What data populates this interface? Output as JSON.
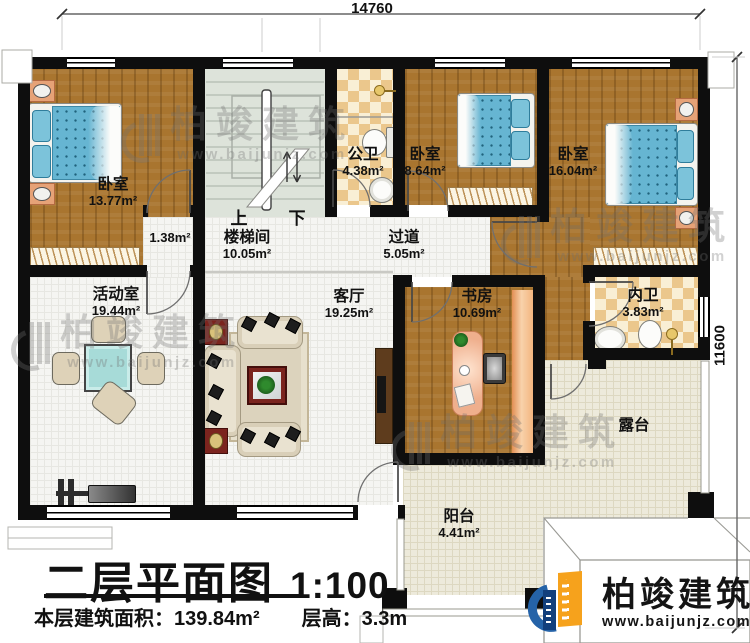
{
  "dimensions": {
    "top": "14760",
    "right": "11600"
  },
  "rooms": {
    "bedroom_left": {
      "name": "卧室",
      "area": "13.77m²"
    },
    "small_hall": {
      "area": "1.38m²"
    },
    "stairwell": {
      "name": "楼梯间",
      "area": "10.05m²",
      "up": "上",
      "down": "下"
    },
    "public_bath": {
      "name": "公卫",
      "area": "4.38m²"
    },
    "bedroom_mid": {
      "name": "卧室",
      "area": "8.64m²"
    },
    "bedroom_right": {
      "name": "卧室",
      "area": "16.04m²"
    },
    "hallway": {
      "name": "过道",
      "area": "5.05m²"
    },
    "activity": {
      "name": "活动室",
      "area": "19.44m²"
    },
    "living": {
      "name": "客厅",
      "area": "19.25m²"
    },
    "study": {
      "name": "书房",
      "area": "10.69m²"
    },
    "ensuite_bath": {
      "name": "内卫",
      "area": "3.83m²"
    },
    "terrace": {
      "name": "露台"
    },
    "balcony": {
      "name": "阳台",
      "area": "4.41m²"
    }
  },
  "title_block": {
    "title": "二层平面图",
    "scale": "1:100",
    "area_label": "本层建筑面积：",
    "area_value": "139.84m²",
    "floor_height_label": "层高：",
    "floor_height_value": "3.3m"
  },
  "branding": {
    "watermark_brand": "柏竣建筑",
    "watermark_url": "www.baijunjz.com",
    "logo_brand": "柏竣建筑",
    "logo_url": "www.baijunjz.com"
  },
  "colors": {
    "wall": "#0e0e0e",
    "wood_floor": "#a9752f",
    "bath_tile": "#ebc78c",
    "bed_blue": "#66b5d2",
    "brand_blue": "#2563a8",
    "brand_orange": "#f6a21c"
  }
}
